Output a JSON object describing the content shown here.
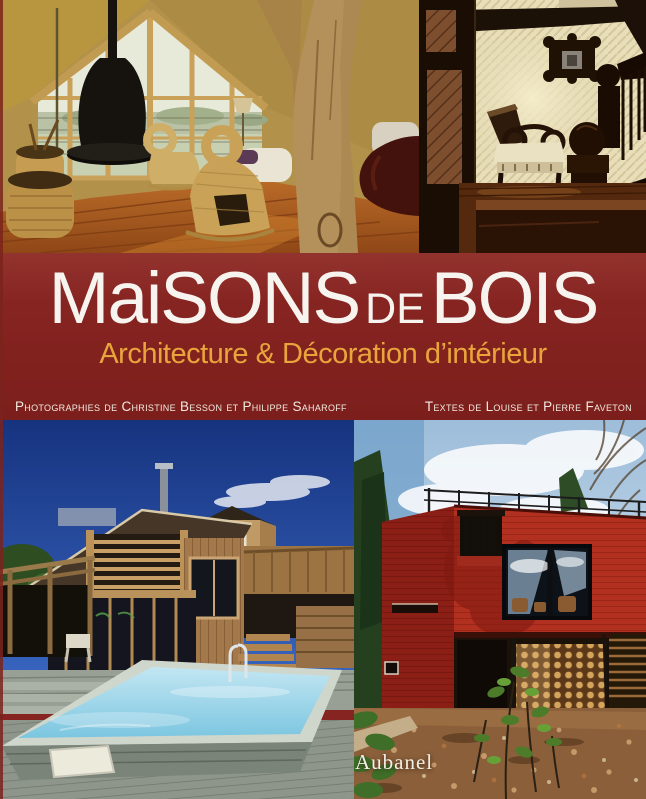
{
  "cover": {
    "title": {
      "part1": "MaiSONS",
      "part2": "de",
      "part3": "BOIS"
    },
    "subtitle": "Architecture & Décoration d’intérieur",
    "credits_left": "Photographies de Christine Besson et Philippe Saharoff",
    "credits_right": "Textes de Louise et Pierre Faveton",
    "publisher": "Aubanel"
  },
  "colors": {
    "band": "#862421",
    "title": "#f7f4ef",
    "subtitle": "#e9a43c",
    "credits": "#f0e9e0",
    "publisher": "#f2efe6"
  },
  "photos": [
    {
      "id": "photo-aframe-interior",
      "alt": "A-frame timber interior with black suspended fireplace, glazed gable wall, wicker baskets, wicker rocking sculptures and a gnarled tree-trunk column"
    },
    {
      "id": "photo-dark-interior",
      "alt": "Dark wooden interior with diagonal-plank door, scroll-arm chair with cream cushion, carved wall frame and staircase with ball-top newel posts"
    },
    {
      "id": "photo-pool-house",
      "alt": "Modern cedar house with slanted roof, octagonal tower and long turquoise swimming pool set in a grey timber deck under deep blue sky"
    },
    {
      "id": "photo-red-house",
      "alt": "Red boxy timber house with roof terrace railing, large reflecting window, firewood stacked beneath the cantilever, autumn ground and green saplings"
    }
  ]
}
